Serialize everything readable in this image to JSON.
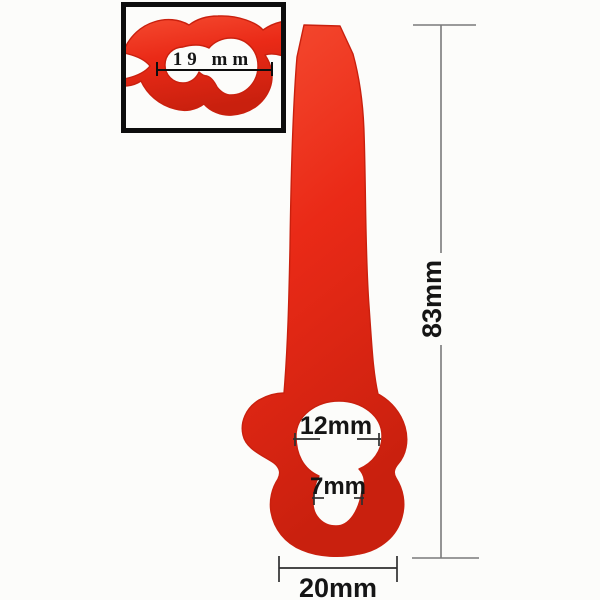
{
  "annotations": {
    "height_label": "83mm",
    "width_label": "20mm",
    "large_hole_label": "12mm",
    "small_hole_label": "7mm",
    "inset_hole_label": "19 mm"
  },
  "colors": {
    "background": "#fcfcfa",
    "blade_red": "#ea2a17",
    "blade_red_light": "#f4482e",
    "blade_red_dark": "#c9200e",
    "dimension_line_dark": "#2f2f2f",
    "dimension_line_gray": "#7a7a7a",
    "label_text": "#151515",
    "inset_frame": "#0d0d0d"
  }
}
